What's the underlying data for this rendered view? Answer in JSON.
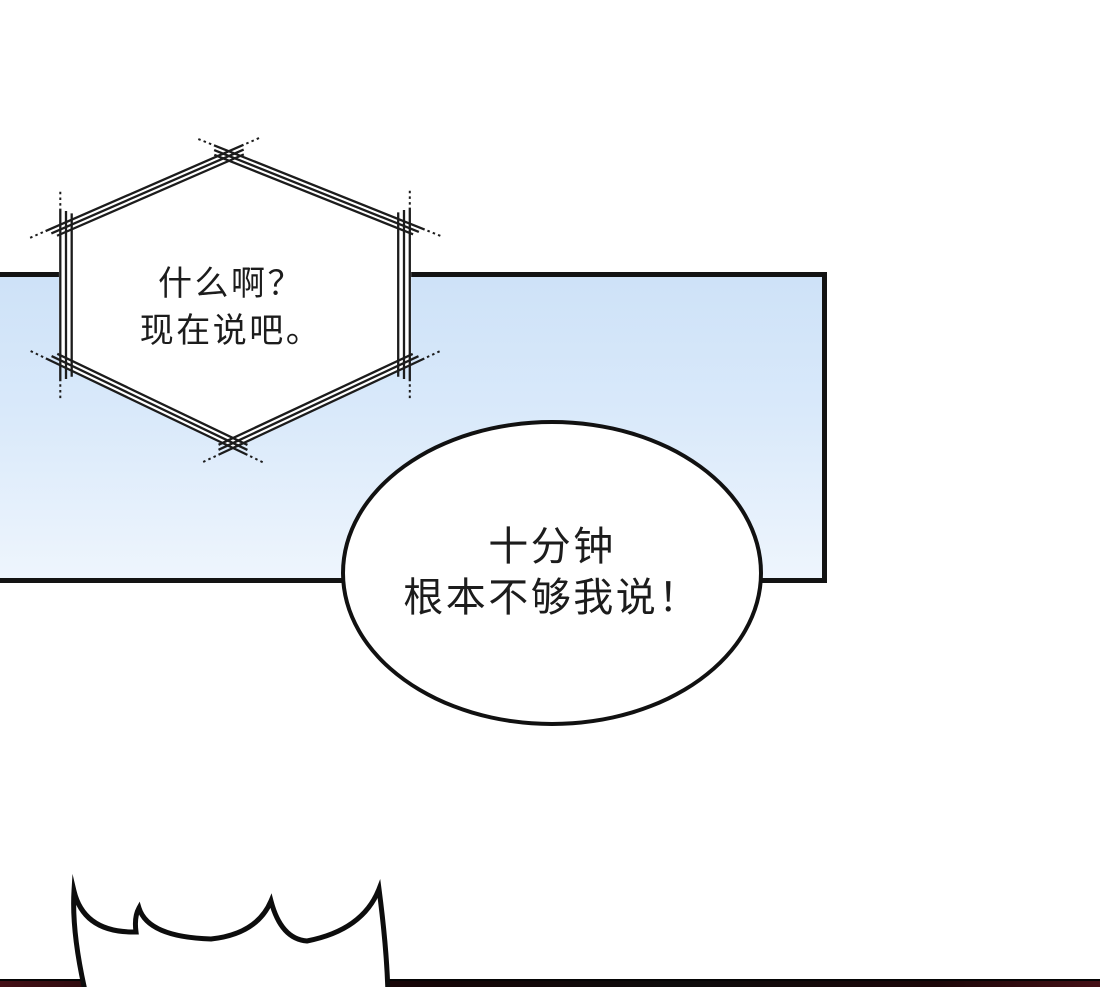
{
  "scene": {
    "kind": "comic-panel-page"
  },
  "bubbles": {
    "hex": {
      "line1": "什么啊？",
      "line2": "现在说吧。"
    },
    "oval": {
      "line1": "十分钟",
      "line2": "根本不够我说！"
    }
  },
  "css_vars": {
    "panel-top": "#cee2f8",
    "panel-bottom": "#eef5fd",
    "panel-border": "#131313",
    "ink": "#1c1c1c",
    "bar-maroon": "#441016",
    "bar-black": "#0e0c0c"
  }
}
